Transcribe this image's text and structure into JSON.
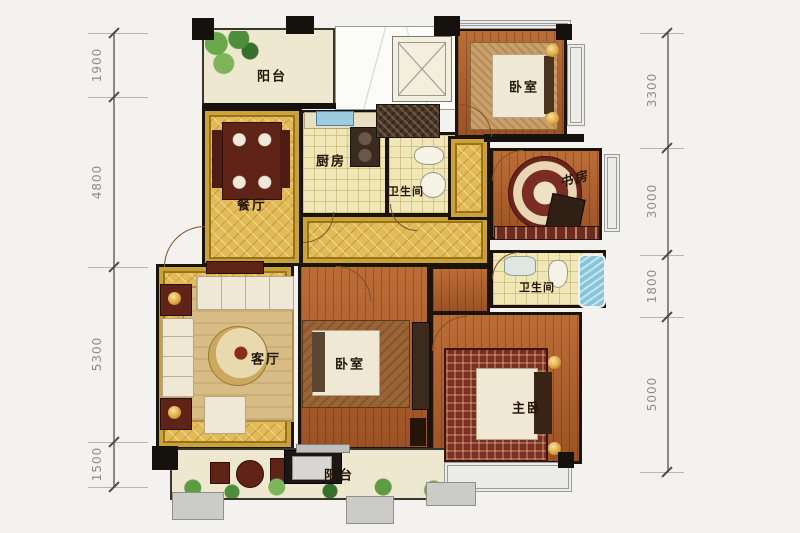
{
  "page": {
    "type": "residential-floor-plan"
  },
  "rooms": [
    {
      "id": "balcony-top",
      "label": "阳台"
    },
    {
      "id": "bedroom-top",
      "label": "卧室"
    },
    {
      "id": "dining-room",
      "label": "餐厅"
    },
    {
      "id": "kitchen",
      "label": "厨房"
    },
    {
      "id": "bathroom-1",
      "label": "卫生间"
    },
    {
      "id": "study",
      "label": "书房"
    },
    {
      "id": "bathroom-2",
      "label": "卫生间"
    },
    {
      "id": "living-room",
      "label": "客厅"
    },
    {
      "id": "bedroom-mid",
      "label": "卧室"
    },
    {
      "id": "master-bedroom",
      "label": "主卧"
    },
    {
      "id": "balcony-bottom",
      "label": "阳台"
    }
  ],
  "dimensions": {
    "left": [
      {
        "value": "1900"
      },
      {
        "value": "4800"
      },
      {
        "value": "5300"
      },
      {
        "value": "1500"
      }
    ],
    "right": [
      {
        "value": "3300"
      },
      {
        "value": "3000"
      },
      {
        "value": "1800"
      },
      {
        "value": "5000"
      }
    ]
  },
  "colors": {
    "background": "#f4f2ee",
    "wall": "#1b140c",
    "wood_floor": "#b0602e",
    "gold_floor": "#e2ba58",
    "tile_floor": "#f0e6b6",
    "balcony_floor": "#eee8d0",
    "furniture_maroon": "#5f2318",
    "bed_cream": "#efe8d5",
    "water_blue": "#86c6d8",
    "plant_green": "#5e9c44",
    "window_gray": "#9c9c9a",
    "dimension_text": "#8f8d88"
  }
}
